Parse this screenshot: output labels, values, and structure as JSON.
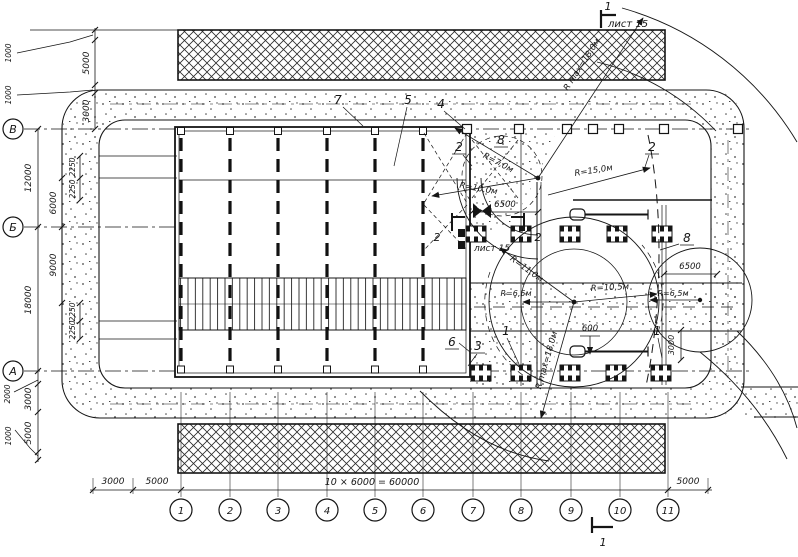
{
  "axes": {
    "rows": [
      "В",
      "Б",
      "А"
    ],
    "cols": [
      "1",
      "2",
      "3",
      "4",
      "5",
      "6",
      "7",
      "8",
      "9",
      "10",
      "11"
    ]
  },
  "dims": {
    "b3000": "3000",
    "b5000l": "5000",
    "bmain": "10 × 6000 = 60000",
    "b5000r": "5000",
    "lt5000": "5000",
    "lt1000a": "1000",
    "lt3000": "3000",
    "lt1000b": "1000",
    "lv12000": "12000",
    "lv6000": "6000",
    "lv2250a": "2250",
    "lv2250b": "2250",
    "lb18000": "18000",
    "lb9000": "9000",
    "lb2250a": "2250",
    "lb2250b": "2250",
    "la2000": "2000",
    "la3000": "3000",
    "la5000": "5000",
    "la1000": "1000",
    "g6500": "6500",
    "r6500": "6500",
    "v600": "600",
    "v3000": "3000"
  },
  "radii": {
    "r7": "R=7,0м",
    "r10": "R=10,0м",
    "r15": "R=15,0м",
    "r11": "R=11,0м",
    "r65a": "R=6,5м",
    "r105": "R=10,5м",
    "r65b": "R=6,5м",
    "rmax1": "R max=18,0м",
    "rmax2": "R max=18,0м"
  },
  "callouts": {
    "c1a": "1",
    "c1b": "1",
    "c2a": "2",
    "c2b": "2",
    "c3": "3",
    "c4": "4",
    "c5": "5",
    "c6": "6",
    "c7": "7",
    "c8a": "8",
    "c8b": "8"
  },
  "sections": {
    "s1_top": "1",
    "s1_bottom": "1",
    "s2_left": "2",
    "s2_right": "2",
    "sheet_top": "лист 15",
    "sheet_mid": "лист 15"
  },
  "colors": {
    "ink": "#1b1b1b",
    "paper": "#ffffff"
  }
}
